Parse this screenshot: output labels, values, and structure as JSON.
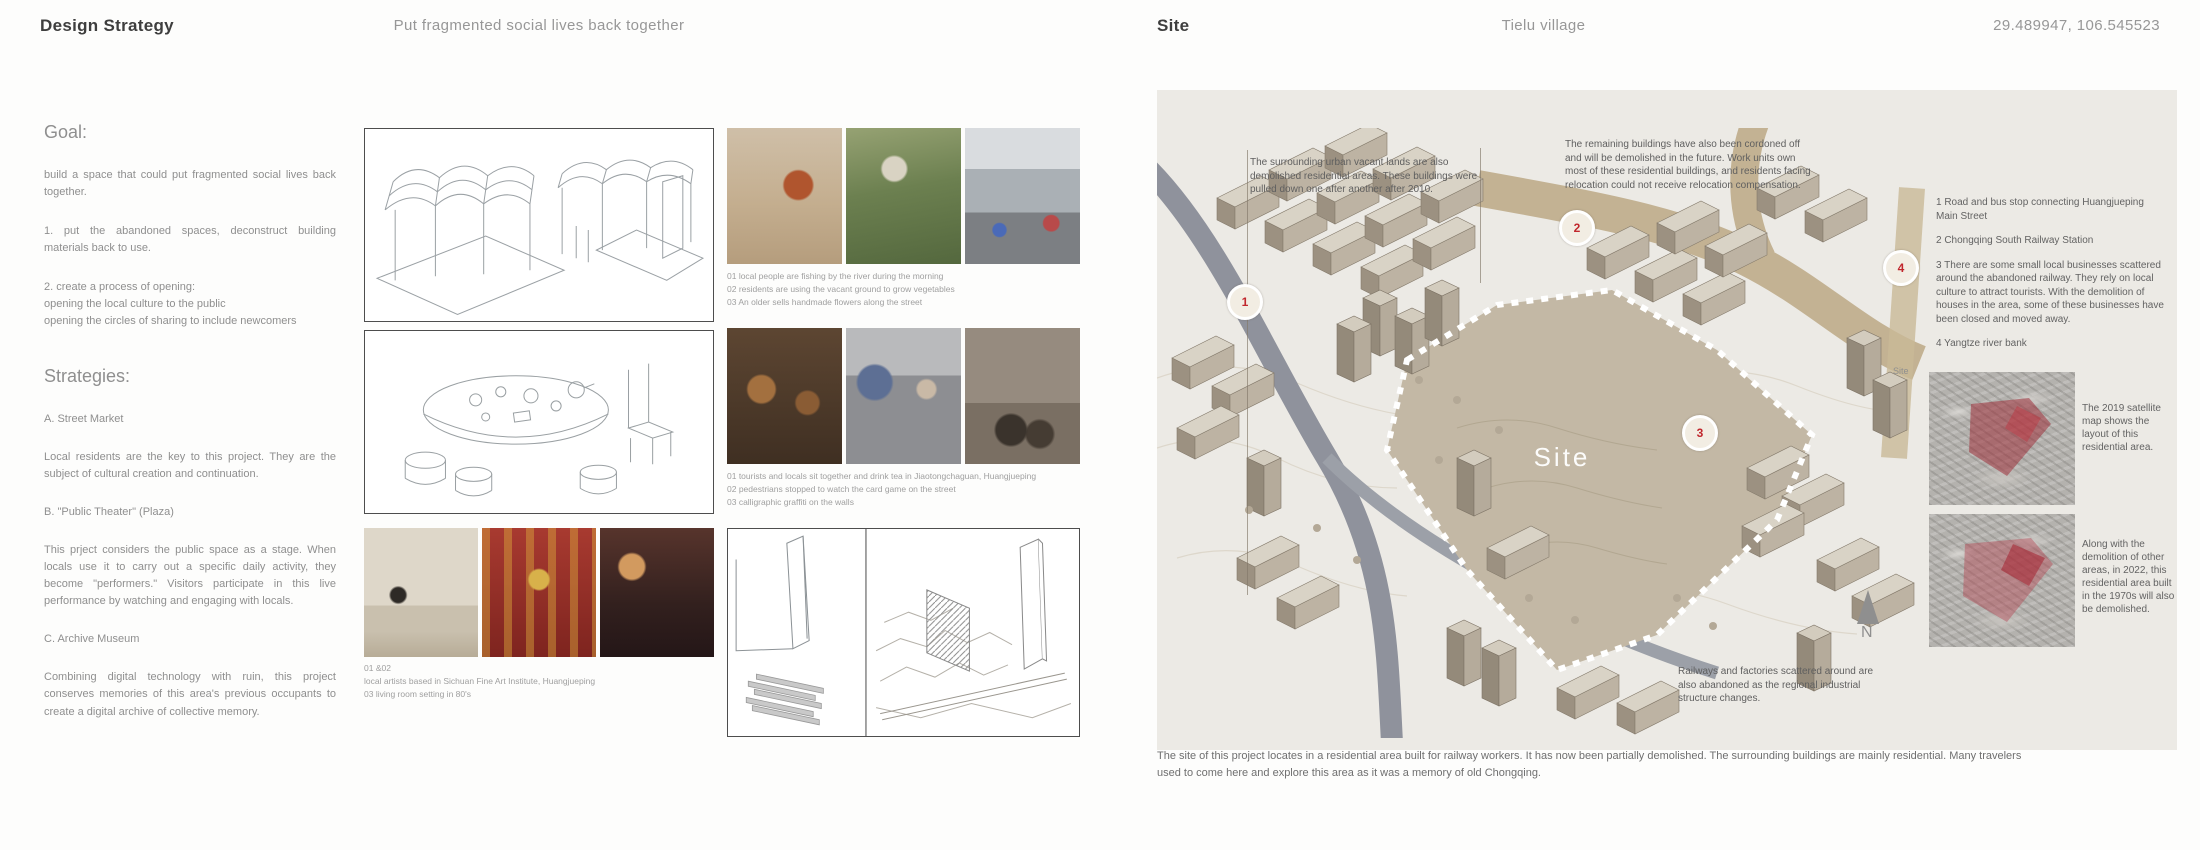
{
  "left_page": {
    "header": {
      "title": "Design Strategy",
      "subtitle": "Put fragmented social lives back together"
    },
    "goal": {
      "heading": "Goal:",
      "p1": "build a space that could put fragmented social lives back together.",
      "p2": "1. put the abandoned spaces, deconstruct building materials back to use.",
      "p3": "2. create a process of opening:\nopening the local culture to the public\nopening the circles of sharing to include newcomers"
    },
    "strategies": {
      "heading": "Strategies:",
      "a_label": "A. Street Market",
      "a_body": "Local residents are the key to this project. They are the subject of cultural creation and continuation.",
      "b_label": "B. \"Public Theater\" (Plaza)",
      "b_body": "This prject considers the public space as a stage. When locals use it to carry out a specific daily activity, they become \"performers.\"  Visitors participate in this live performance by watching and engaging with locals.",
      "c_label": "C. Archive Museum",
      "c_body": "Combining digital technology with ruin, this project conserves memories of this area's previous occupants to create a digital archive of collective memory."
    },
    "captions": {
      "set1_l1": "01 local people are fishing by the river during the morning",
      "set1_l2": "02 residents are using the vacant ground to grow vegetables",
      "set1_l3": "03 An older sells handmade flowers along the street",
      "set2_l1": "01 tourists and locals sit together and drink tea in Jiaotongchaguan, Huangjueping",
      "set2_l2": "02 pedestrians stopped to watch the card game on the street",
      "set2_l3": "03 calligraphic graffiti on the walls",
      "set3_l1": "01 &02",
      "set3_l2": "local artists based in Sichuan Fine Art Institute, Huangjueping",
      "set3_l3": "03 living room setting in 80's"
    }
  },
  "right_page": {
    "header": {
      "title": "Site",
      "subtitle": "Tielu village",
      "coordinates": "29.489947, 106.545523"
    },
    "map": {
      "annotation_top_left": "The surrounding urban vacant lands are also demolished residential areas. These buildings were pulled down one after another after 2010.",
      "annotation_top_right": "The remaining buildings have also been cordoned off and will be demolished in the future. Work units own most of these residential buildings, and residents facing relocation could not receive relocation compensation.",
      "annotation_bottom": "Railways and factories scattered around are also abandoned as the regional industrial structure changes.",
      "site_label": "Site",
      "markers": [
        "1",
        "2",
        "3",
        "4"
      ],
      "compass_label": "N"
    },
    "legend": {
      "item1": "1 Road and bus stop connecting Huangjueping Main Street",
      "item2": "2 Chongqing South Railway Station",
      "item3": "3 There are some small local businesses scattered around the abandoned railway. They rely on local culture to attract tourists. With the demolition of houses in the area, some of these businesses have been closed and moved away.",
      "item4": "4 Yangtze river bank"
    },
    "satellite": {
      "corner_label": "Site",
      "caption_2019": "The 2019 satellite map shows the layout of this residential area.",
      "caption_2022": "Along with the demolition of other areas, in 2022, this residential area built in the 1970s will also be demolished."
    },
    "footer": "The site of this project locates in a residential area built for railway workers. It has now been partially demolished. The surrounding buildings are mainly residential. Many travelers used to come here and explore this area as it was a memory of old Chongqing."
  },
  "colors": {
    "accent_red": "#c1272d",
    "paper": "#eceae5",
    "road_gray": "#8f929c",
    "road_tan": "#c3b293",
    "site_fill": "#c3b8a5",
    "satellite_overlay_red": "#9b2330"
  }
}
